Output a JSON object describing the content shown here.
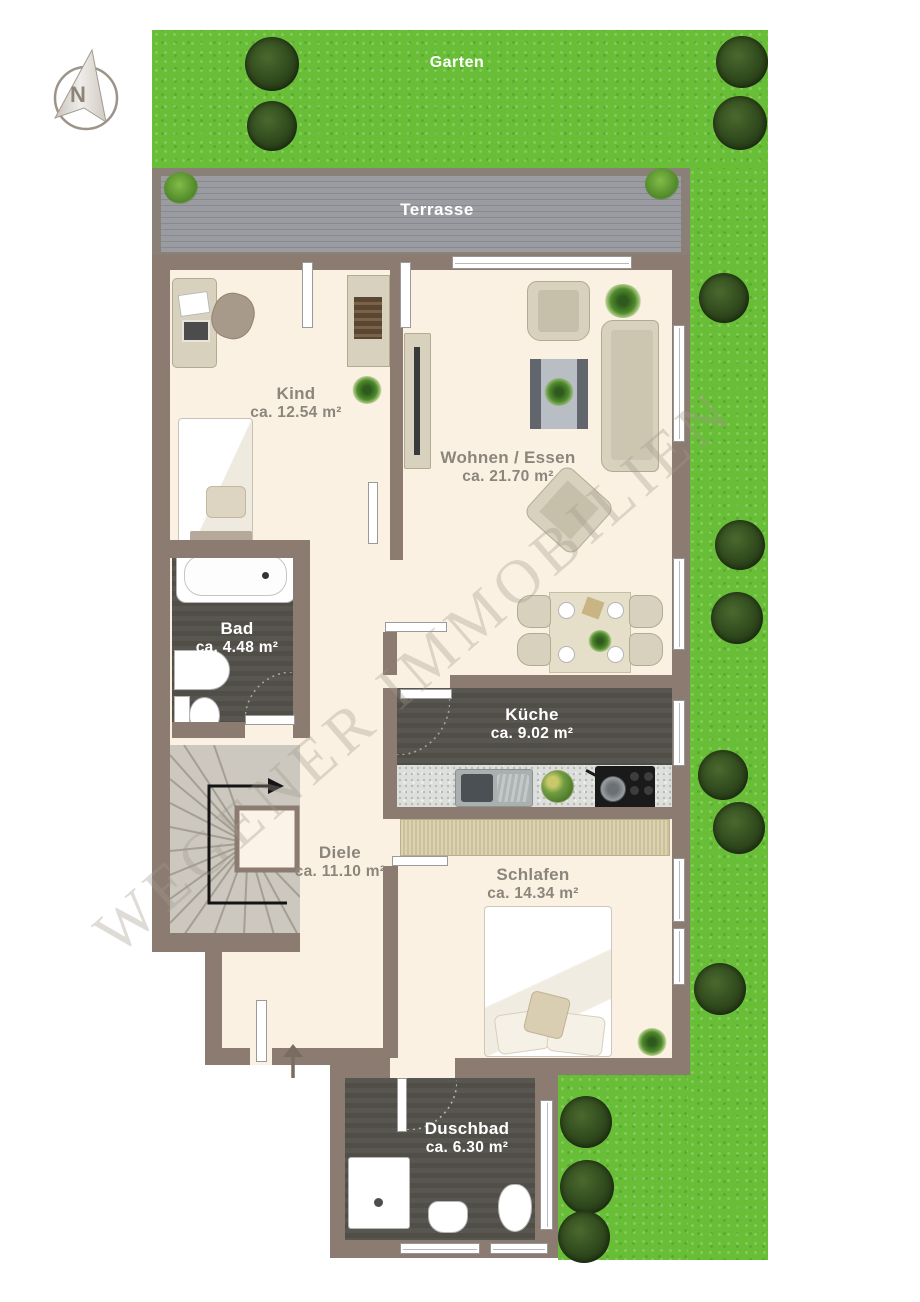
{
  "compass": {
    "label": "N"
  },
  "watermark": {
    "text": "WEGENER IMMOBILIEN"
  },
  "outdoor": {
    "garden": {
      "label": "Garten"
    },
    "terrace": {
      "label": "Terrasse"
    }
  },
  "rooms": [
    {
      "name": "Kind",
      "area": "ca. 12.54 m²"
    },
    {
      "name": "Wohnen / Essen",
      "area": "ca. 21.70 m²"
    },
    {
      "name": "Bad",
      "area": "ca. 4.48 m²"
    },
    {
      "name": "Küche",
      "area": "ca. 9.02 m²"
    },
    {
      "name": "Diele",
      "area": "ca. 11.10 m²"
    },
    {
      "name": "Schlafen",
      "area": "ca. 14.34 m²"
    },
    {
      "name": "Duschbad",
      "area": "ca. 6.30 m²"
    }
  ],
  "colors": {
    "wall": "#8c7b70",
    "floor": "#fbf1e3",
    "wet_room_floor": "#55534e",
    "grass": "#69be37",
    "bush": "#2f481c",
    "terrace_deck": "#94969b",
    "label": "#8b867c",
    "label_on_dark": "#ffffff"
  }
}
